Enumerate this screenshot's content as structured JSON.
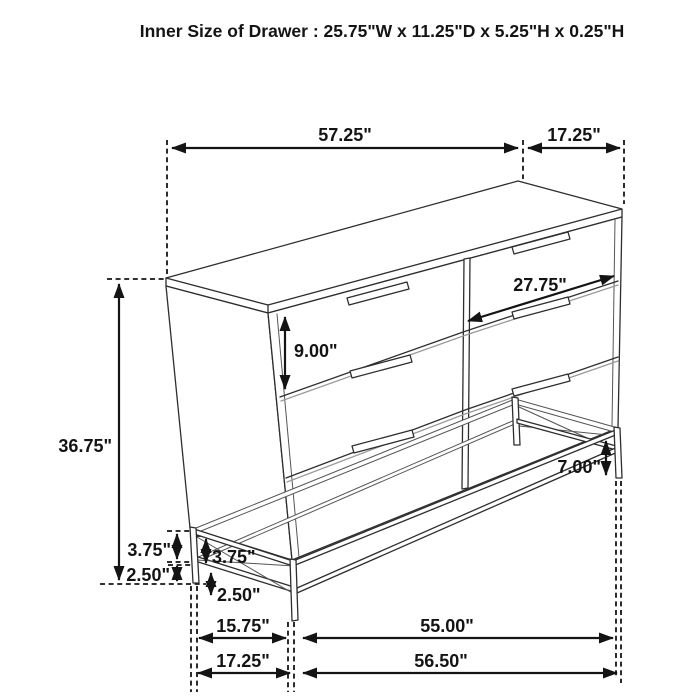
{
  "title": "Inner Size of Drawer : 25.75\"W x 11.25\"D x 5.25\"H x 0.25\"H",
  "diagram": {
    "subject": "six-drawer dresser with metal sled base, isometric line drawing with dimension callouts",
    "units": "inches",
    "colors": {
      "ink": "#141414",
      "drawing_line": "#2e2e2e",
      "background": "#ffffff"
    }
  },
  "dims": {
    "top_width": "57.25\"",
    "top_depth": "17.25\"",
    "drawer_width": "27.75\"",
    "drawer_height": "9.00\"",
    "overall_height": "36.75\"",
    "right_base_height": "7.00\"",
    "base_upper_outer": "3.75\"",
    "base_upper_inner": "3.75\"",
    "base_lower_outer": "2.50\"",
    "base_lower_inner": "2.50\"",
    "base_depth_inner": "15.75\"",
    "base_width_inner": "55.00\"",
    "base_depth_outer": "17.25\"",
    "base_width_outer": "56.50\""
  }
}
